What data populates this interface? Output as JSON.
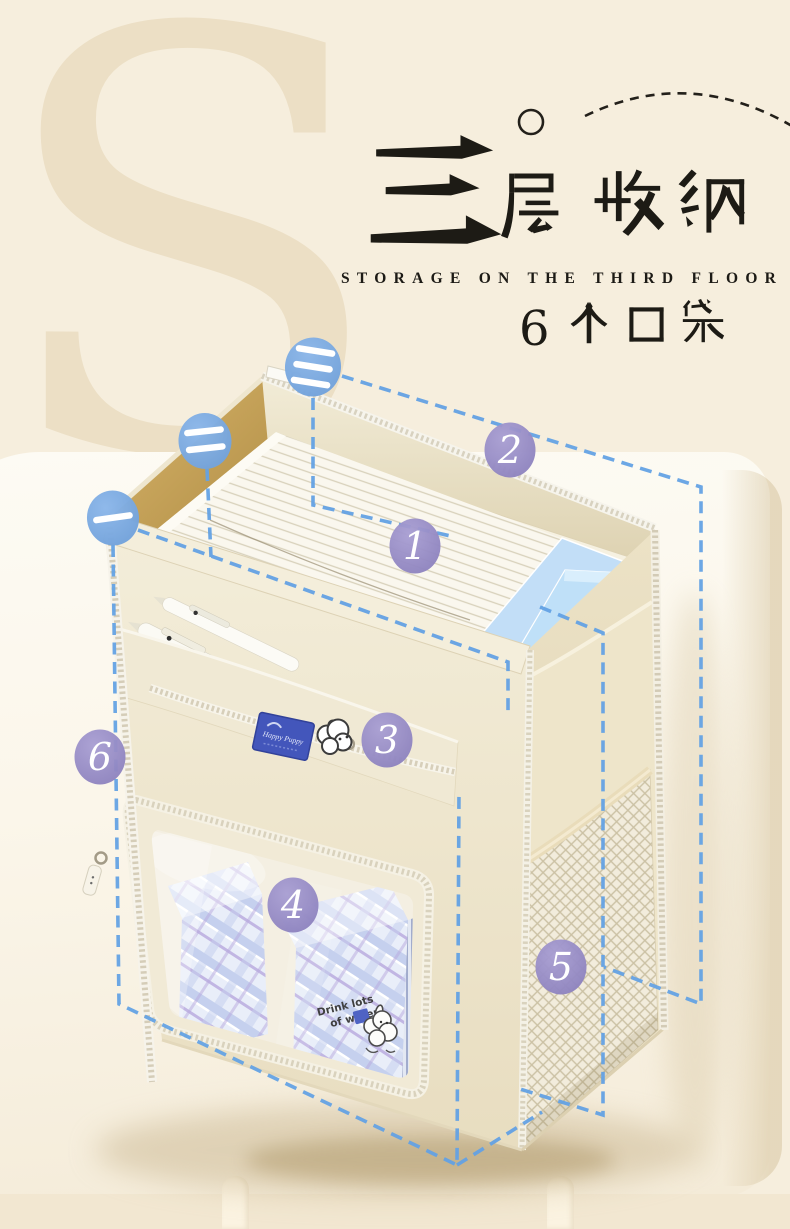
{
  "page": {
    "background_color": "#f6eedd",
    "panel_color": "#fcf8ef",
    "floor_color": "#f2e7d1",
    "watermark_letter": "S"
  },
  "title": {
    "heading_cn": "三层收纳",
    "heading_en": "STORAGE ON THE THIRD FLOOR",
    "pocket_count_cn": "6个口袋"
  },
  "callouts": {
    "layer_badges": [
      "一",
      "二",
      "三"
    ],
    "pocket_badges": [
      "1",
      "2",
      "3",
      "4",
      "5",
      "6"
    ],
    "layer_badge_color": "#7dabdf",
    "pocket_badge_color": "#9187c2",
    "dash_color": "#64a2e4"
  },
  "product": {
    "brand_label": "Happy Puppy",
    "memo_text": "Drink lots of water!"
  }
}
